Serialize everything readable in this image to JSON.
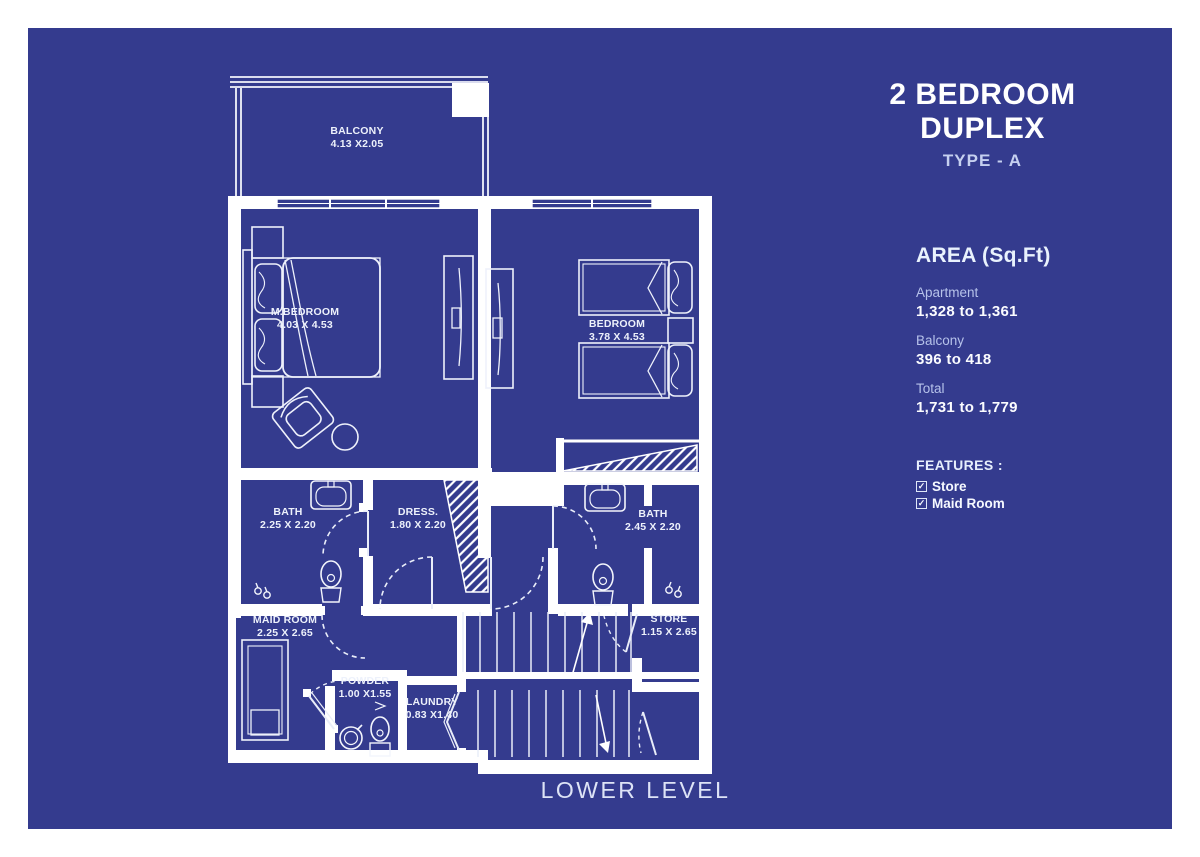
{
  "title": "2 BEDROOM DUPLEX",
  "subtitle": "TYPE - A",
  "level_label": "LOWER LEVEL",
  "area": {
    "heading": "AREA (Sq.Ft)",
    "items": [
      {
        "label": "Apartment",
        "value": "1,328 to 1,361"
      },
      {
        "label": "Balcony",
        "value": "396 to 418"
      },
      {
        "label": "Total",
        "value": "1,731 to 1,779"
      }
    ]
  },
  "features": {
    "heading": "FEATURES :",
    "check_glyph": "✓",
    "items": [
      {
        "label": "Store"
      },
      {
        "label": "Maid Room"
      }
    ]
  },
  "rooms": [
    {
      "name": "BALCONY",
      "dims": "4.13 X2.05"
    },
    {
      "name": "M.BEDROOM",
      "dims": "4.03 X 4.53"
    },
    {
      "name": "BEDROOM",
      "dims": "3.78 X 4.53"
    },
    {
      "name": "BATH",
      "dims": "2.25 X 2.20"
    },
    {
      "name": "DRESS.",
      "dims": "1.80 X 2.20"
    },
    {
      "name": "BATH",
      "dims": "2.45 X 2.20"
    },
    {
      "name": "MAID ROOM",
      "dims": "2.25 X 2.65"
    },
    {
      "name": "STORE",
      "dims": "1.15 X 2.65"
    },
    {
      "name": "POWDER",
      "dims": "1.00 X1.55"
    },
    {
      "name": "LAUNDRY",
      "dims": "0.83 X1.40"
    }
  ],
  "colors": {
    "background": "#ffffff",
    "panel": "#343b8e",
    "line": "#ffffff"
  }
}
